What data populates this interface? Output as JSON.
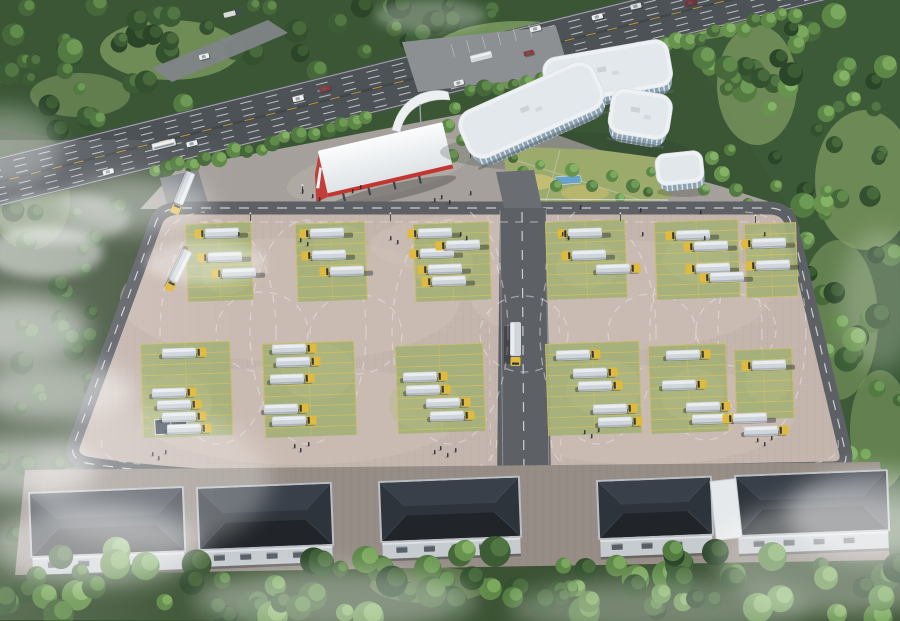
{
  "scene": {
    "title": "Aerial rendering of a truck depot and driver-training facility",
    "setting": "Bird's-eye view: highway with traffic at top, white office complex with courtyard, red-trimmed inspection canopy, huge paved training lot with green truck parking bays and dashed driving-course loops, flat-roofed warehouses along the bottom, dense forest and drifting fog around the site",
    "counts": {
      "highway_vehicles": 14,
      "frontage_vehicles": 6,
      "parked_trucks": 46,
      "moving_trucks": 4,
      "parking_blocks": 12,
      "course_loops": 11,
      "warehouses": 5,
      "people": 49
    }
  },
  "palette": {
    "forestDark": "#2b4529",
    "forestMid": "#3b5c35",
    "forestLight": "#5d8747",
    "meadow": "#7d9a60",
    "highway": "#4d5257",
    "laneWhite": "#e2e5e7",
    "laneYellow": "#c8a23c",
    "apron": "#a5a09b",
    "lotPaving": "#c4b5ad",
    "lotLight": "#cfc1b8",
    "roadGray": "#5d6166",
    "bayGreen": "#a3b077",
    "bayLine": "#d6c160",
    "truckCab": "#e0ba3d",
    "truckTrailer": "#cfd5da",
    "truckTop": "#e9edf0",
    "buildingRoof": "#eef1f3",
    "glass": "#8aa2b2",
    "mullion": "#e8edf0",
    "canopyRed": "#c23531",
    "canopyWhite": "#f2f4f5",
    "warehouseRoof": "#2e343b",
    "warehouseRoofLight": "#3a4049",
    "warehouseRoofDark": "#212529",
    "warehouseWall": "#c6cbcf",
    "warehouseSlot": "#565e66",
    "forecourt": "#968d86",
    "courtyardGreen": "#9cab6c",
    "pond": "#6aa3c8",
    "people": "#272b30",
    "shadow": "#1d2125",
    "fog": "#ffffff"
  }
}
